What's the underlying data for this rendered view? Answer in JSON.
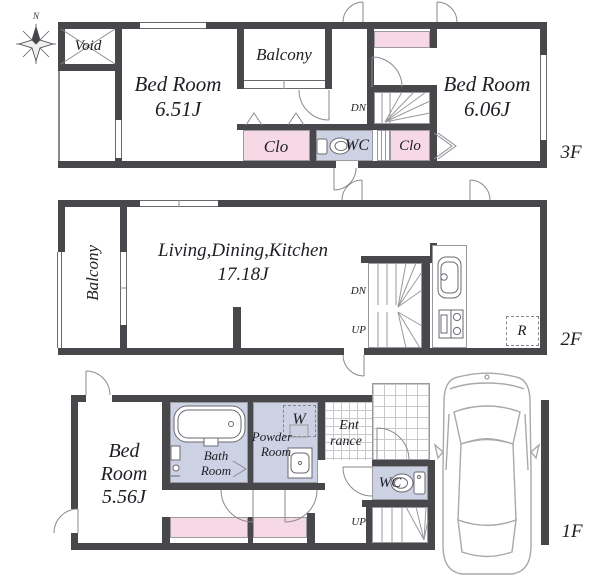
{
  "compass": {
    "north_label": "N"
  },
  "floor3": {
    "floor_label": "3F",
    "void_label": "Void",
    "bedroom1_name": "Bed Room",
    "bedroom1_size": "6.51J",
    "balcony_label": "Balcony",
    "closet_left_label": "Clo",
    "wc_label": "WC",
    "closet_right_label": "Clo",
    "stairs_dn_label": "DN",
    "bedroom2_name": "Bed Room",
    "bedroom2_size": "6.06J"
  },
  "floor2": {
    "floor_label": "2F",
    "balcony_label": "Balcony",
    "ldk_name": "Living,Dining,Kitchen",
    "ldk_size": "17.18J",
    "stairs_dn_label": "DN",
    "stairs_up_label": "UP",
    "refrigerator_label": "R"
  },
  "floor1": {
    "floor_label": "1F",
    "bedroom_name_line1": "Bed",
    "bedroom_name_line2": "Room",
    "bedroom_size": "5.56J",
    "bathroom_line1": "Bath",
    "bathroom_line2": "Room",
    "powder_line1": "Powder",
    "powder_line2": "Room",
    "washer_label": "W",
    "entrance_line1": "Ent",
    "entrance_line2": "rance",
    "wc_label": "WC",
    "stairs_up_label": "UP"
  },
  "colors": {
    "wall": "#48484c",
    "closet_fill": "#f7d9e5",
    "wet_area_fill": "#ccd1e3",
    "line": "#8a8a8e"
  }
}
